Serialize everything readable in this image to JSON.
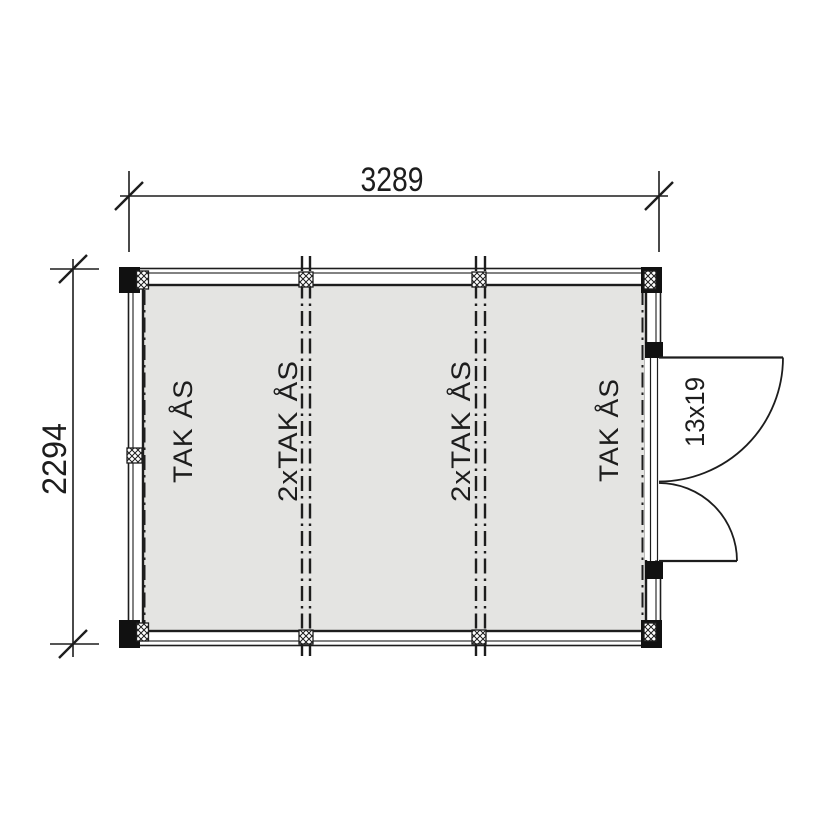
{
  "dimensions": {
    "width_mm": "3289",
    "height_mm": "2294"
  },
  "beams": {
    "left": "TAK ÅS",
    "center_left": "2xTAK ÅS",
    "center_right": "2xTAK ÅS",
    "right": "TAK ÅS"
  },
  "door": {
    "size": "13x19"
  },
  "colors": {
    "line": "#1d1d1d",
    "interior_fill": "#e4e4e2",
    "background": "#ffffff"
  }
}
